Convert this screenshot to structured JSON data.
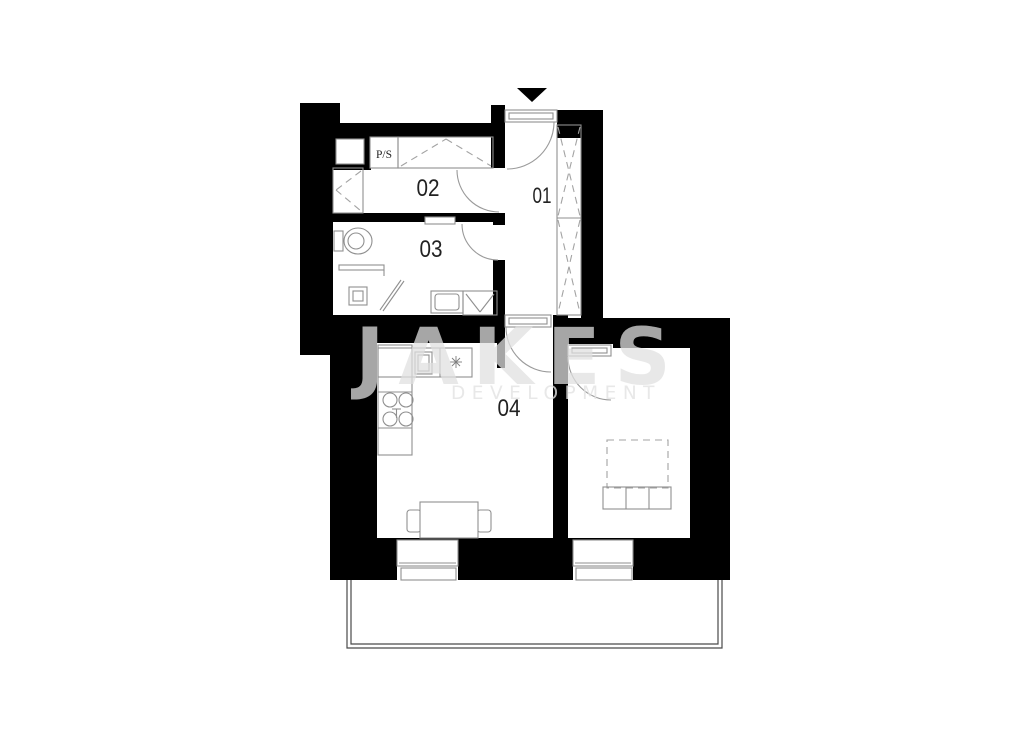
{
  "plan": {
    "room_labels": {
      "hall": "01",
      "room02": "02",
      "bathroom": "03",
      "living_kitchen": "04",
      "pantry": "P/S"
    },
    "watermark": {
      "brand": "JAKES",
      "subtitle": "DEVELOPMENT"
    },
    "colors": {
      "wall": "#000000",
      "furniture_line": "#8f8f8f",
      "label_text": "#222222",
      "balcony_line": "#4a4a4a",
      "watermark": "#e0e0e0"
    }
  }
}
